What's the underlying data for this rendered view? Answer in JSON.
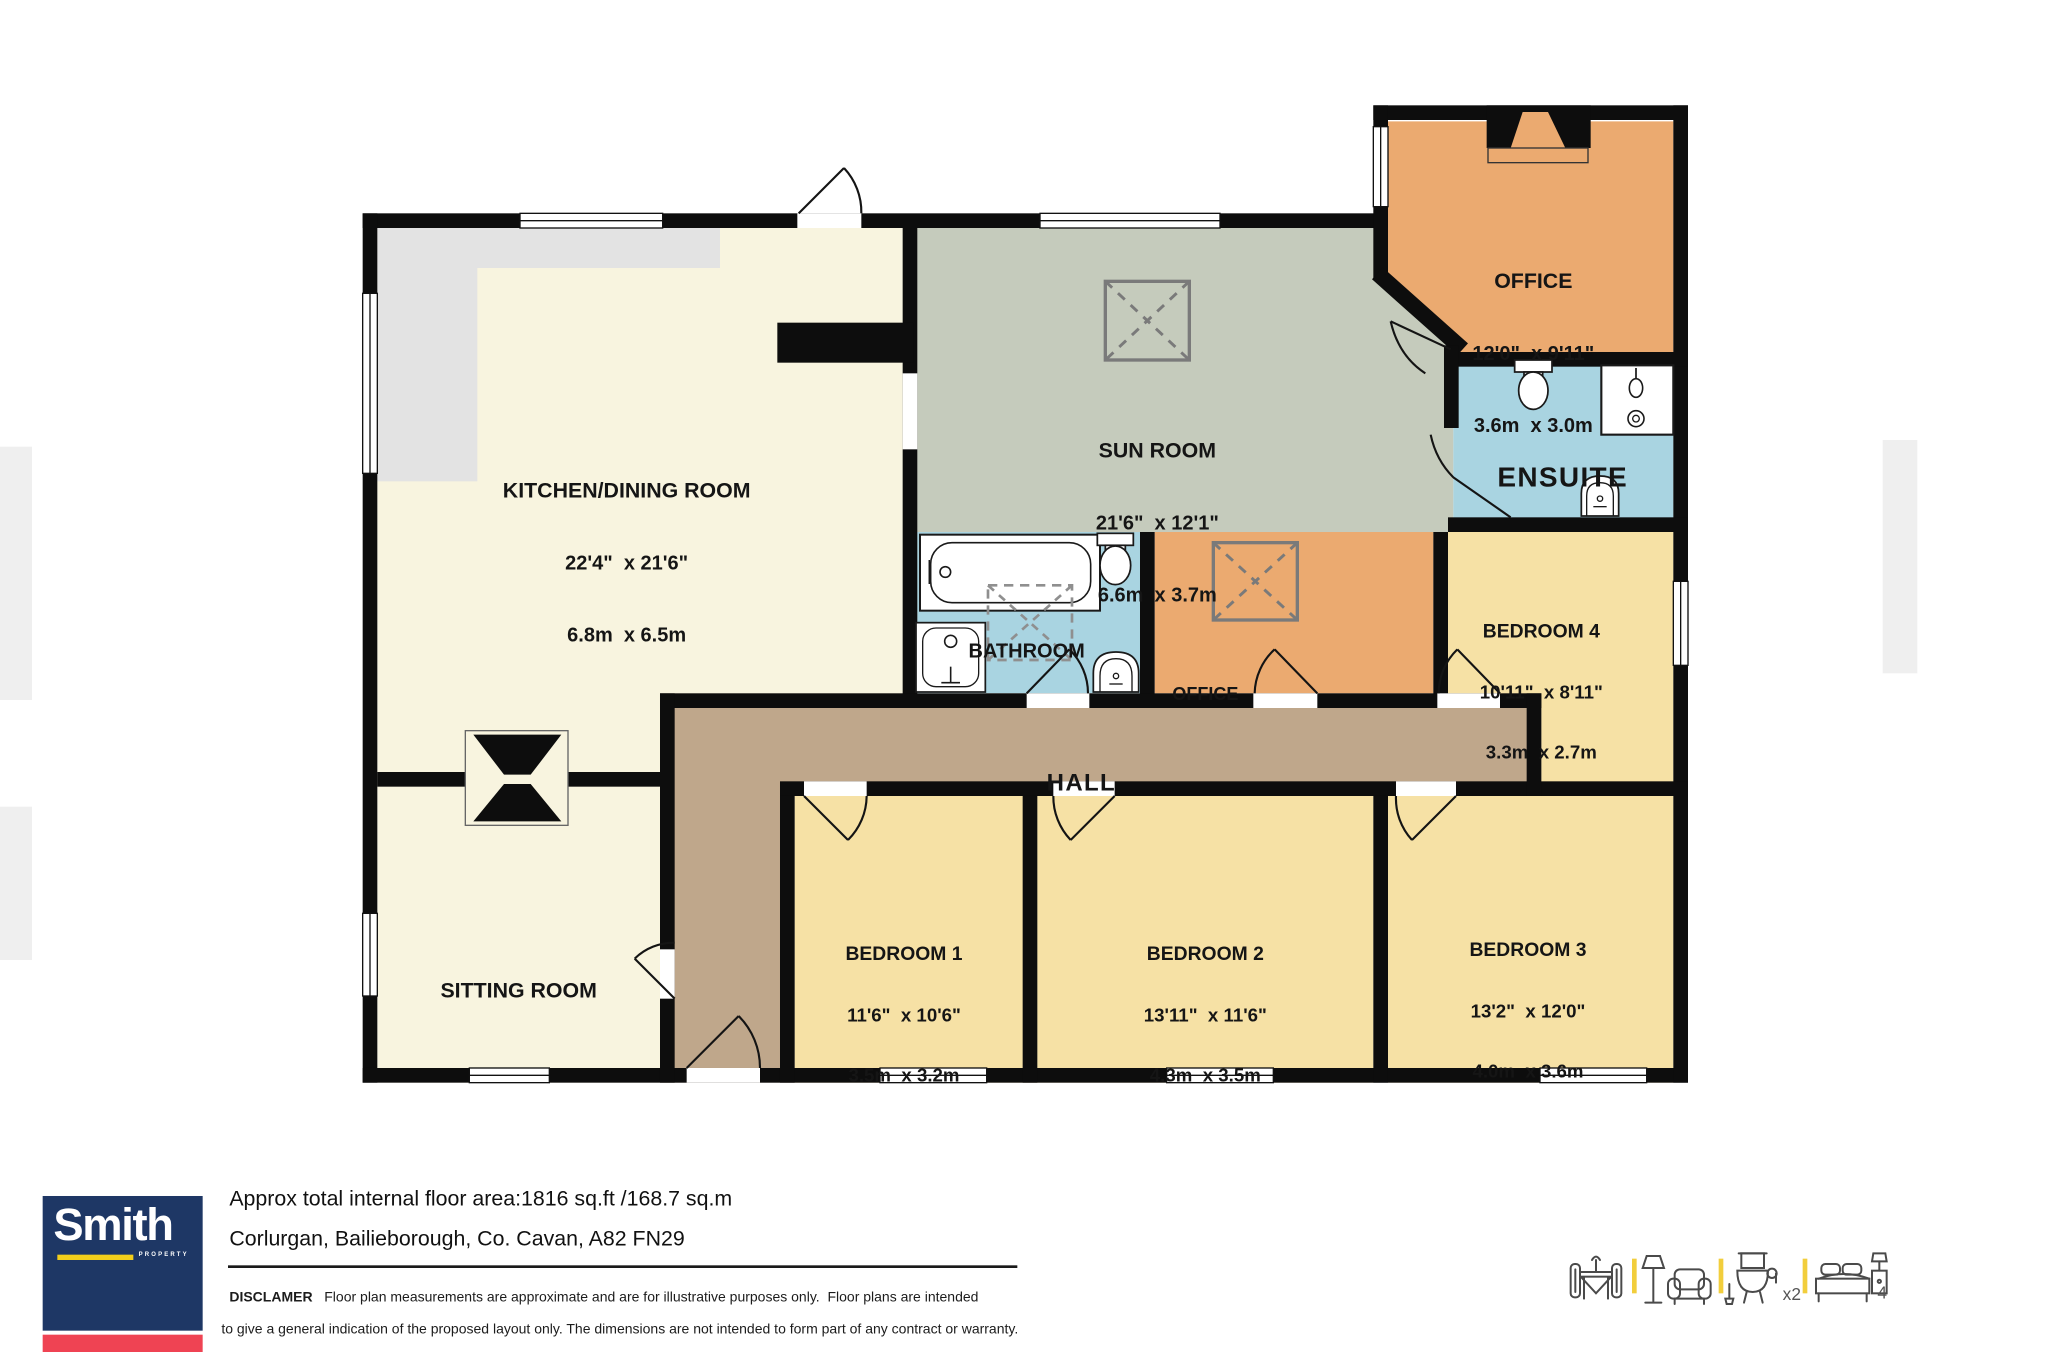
{
  "plan": {
    "rooms": {
      "kitchen": {
        "name": "KITCHEN/DINING ROOM",
        "dims_imperial": "22'4\"  x 21'6\"",
        "dims_metric": "6.8m  x 6.5m"
      },
      "sun_room": {
        "name": "SUN ROOM",
        "dims_imperial": "21'6\"  x 12'1\"",
        "dims_metric": "6.6m  x 3.7m"
      },
      "office_top": {
        "name": "OFFICE",
        "dims_imperial": "12'0\"  x 9'11\"",
        "dims_metric": "3.6m  x 3.0m"
      },
      "ensuite": {
        "name": "ENSUITE"
      },
      "bathroom": {
        "name": "BATHROOM"
      },
      "office_small": {
        "name": "OFFICE"
      },
      "bedroom_4": {
        "name": "BEDROOM 4",
        "dims_imperial": "10'11\"  x 8'11\"",
        "dims_metric": "3.3m  x 2.7m"
      },
      "hall": {
        "name": "HALL"
      },
      "sitting_room": {
        "name": "SITTING ROOM"
      },
      "bedroom_1": {
        "name": "BEDROOM 1",
        "dims_imperial": "11'6\"  x 10'6\"",
        "dims_metric": "3.5m  x 3.2m"
      },
      "bedroom_2": {
        "name": "BEDROOM 2",
        "dims_imperial": "13'11\"  x 11'6\"",
        "dims_metric": "4.3m  x 3.5m"
      },
      "bedroom_3": {
        "name": "BEDROOM 3",
        "dims_imperial": "13'2\"  x 12'0\"",
        "dims_metric": "4.0m  x 3.6m"
      }
    },
    "colors": {
      "wall": "#0D0D0D",
      "cream": "#F8F4DF",
      "counter": "#E3E3E3",
      "sage": "#C5CBBC",
      "orange": "#EBAA70",
      "blue": "#A9D4E1",
      "bedroom_yellow": "#F6E1A5",
      "hall_tan": "#BFA78B"
    }
  },
  "footer": {
    "brand": "Smith",
    "brand_sub": "PROPERTY",
    "brand_colors": {
      "navy": "#1E3765",
      "red": "#EF4353",
      "yellow": "#F2CE1B"
    },
    "area_line": "Approx total internal floor area:1816 sq.ft /168.7 sq.m",
    "address_line": "Corlurgan, Bailieborough, Co. Cavan, A82 FN29",
    "disclaimer_title": "DISCLAMER",
    "disclaimer_line1": "Floor plan measurements are approximate and are for illustrative purposes only.  Floor plans are intended",
    "disclaimer_line2": "to give a general indication of the proposed layout only. The dimensions are not intended to form part of any contract or warranty.",
    "legend": {
      "toilet_count": "x2",
      "bed_count": "4"
    }
  }
}
